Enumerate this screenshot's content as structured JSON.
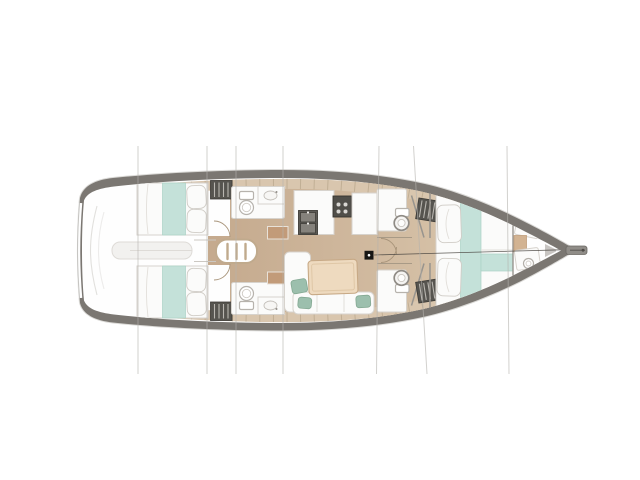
{
  "title": "Sailing yacht interior layout floor plan, top view, bow pointing right",
  "palette": {
    "background": "#ffffff",
    "hull": "#7b7772",
    "hull-halo": "#dbdad7",
    "deck": "#d9c6ae",
    "deck-seam": "#bcaa90",
    "floor-aft": "#c5aa8e",
    "floor-fore": "#d5c0a6",
    "teal": "#c4e1d9",
    "teal-edge": "#abd2c6",
    "furniture": "#fbfbfa",
    "furniture-edge": "#d7d3cd",
    "cushion": "#9cbfad",
    "cushion-edge": "#83a892",
    "wood": "#eedabf",
    "wood-edge": "#c7a986",
    "locker": "#56544f",
    "locker-slat": "#b9b6b0",
    "fixture-dark": "#5c5a55",
    "door-arc": "#a8947a",
    "station-line": "#b4b2ad",
    "ladder": "#c0aa8d",
    "mast": "#171614",
    "bowsprit": "#908d88"
  },
  "rooms": [
    {
      "id": "stern-platform",
      "label": "Stern swim platform"
    },
    {
      "id": "aft-cabin-port",
      "label": "Aft double cabin (port)"
    },
    {
      "id": "aft-cabin-starboard",
      "label": "Aft double cabin (starboard)"
    },
    {
      "id": "companionway",
      "label": "Companionway steps"
    },
    {
      "id": "aft-head-port",
      "label": "Aft head with toilet and sink (port)"
    },
    {
      "id": "aft-head-starboard",
      "label": "Aft head with toilet and sink (starboard)"
    },
    {
      "id": "galley",
      "label": "Galley with sink and stove"
    },
    {
      "id": "salon",
      "label": "Salon with dinette table and settees"
    },
    {
      "id": "forward-head-port",
      "label": "Forward head (port)"
    },
    {
      "id": "forward-head-starboard",
      "label": "Forward head (starboard)"
    },
    {
      "id": "forward-cabin",
      "label": "Forward owner cabin with V-berth"
    },
    {
      "id": "bow-compartment",
      "label": "Bow utility compartment"
    }
  ],
  "features": [
    "mast-post",
    "forestay-line",
    "bowsprit",
    "companionway-ladder",
    "dinette-table",
    "louvered-lockers",
    "deck-seam-ticks"
  ],
  "station_lines": {
    "count": 7,
    "x_positions": [
      138,
      207,
      236,
      283,
      378,
      418,
      508
    ]
  }
}
